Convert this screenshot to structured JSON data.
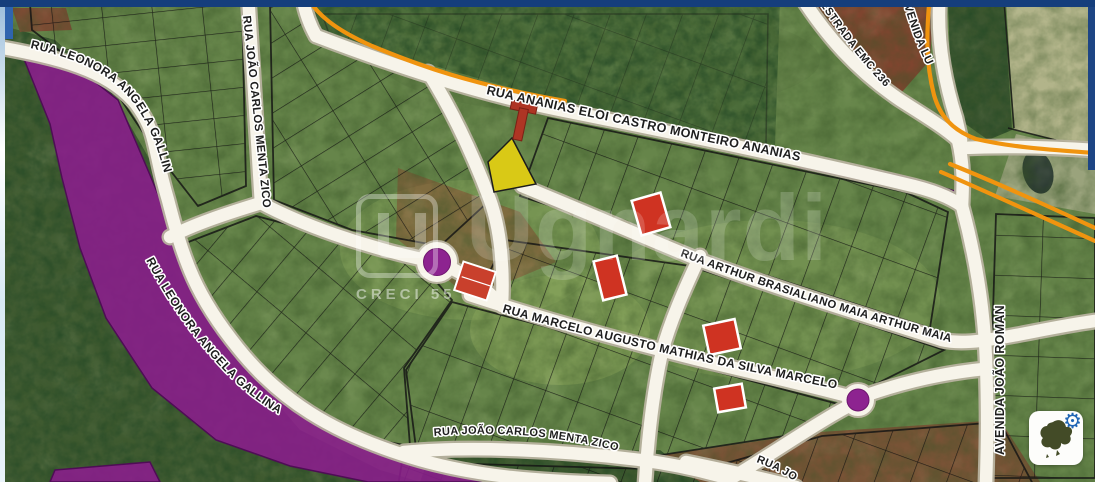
{
  "window": {
    "top_bar_color": "#153e7c",
    "right_edge_color": "#1d4584"
  },
  "map": {
    "type": "cadastral-aerial-viewer",
    "streets": [
      {
        "id": "leonora-gallina-1",
        "label": "RUA LEONORA ANGELA GALLINA"
      },
      {
        "id": "leonora-gallina-2",
        "label": "RUA LEONORA ANGELA GALLINA"
      },
      {
        "id": "zico-north",
        "label": "RUA JOÃO CARLOS MENTA ZICO"
      },
      {
        "id": "zico-south",
        "label": "RUA JOÃO CARLOS MENTA ZICO"
      },
      {
        "id": "ananias",
        "label": "RUA ANANIAS ELOI CASTRO MONTEIRO ANANIAS"
      },
      {
        "id": "arthur-maia",
        "label": "RUA ARTHUR BRASIALIANO MAIA ARTHUR MAIA"
      },
      {
        "id": "marcelo",
        "label": "RUA MARCELO AUGUSTO MATHIAS DA SILVA MARCELO"
      },
      {
        "id": "estrada-emc",
        "label": "ESTRADA EMC 236"
      },
      {
        "id": "avenida-lu",
        "label": "AVENIDA LU"
      },
      {
        "id": "avenida-joao-roman",
        "label": "AVENIDA JOÃO ROMAN"
      },
      {
        "id": "rua-jo-partial",
        "label": "RUA JO"
      }
    ],
    "zones": [
      {
        "name": "restricted-area-west",
        "color": "#8b1d8d"
      },
      {
        "name": "restricted-area-northeast",
        "color": "#8b1d8d"
      },
      {
        "name": "restricted-area-south",
        "color": "#8b1d8d"
      }
    ],
    "highlight_roads": {
      "color": "#f0940f"
    },
    "markers": [
      {
        "shape": "circle",
        "fill": "#8d2390",
        "ring": "#ffffff",
        "x": 437,
        "y": 262
      },
      {
        "shape": "circle",
        "fill": "#8d2390",
        "ring": "#ffffff",
        "x": 858,
        "y": 400
      }
    ],
    "lots": [
      {
        "status_color": "#cf3322",
        "x": 651,
        "y": 214
      },
      {
        "status_color": "#cf3322",
        "x": 610,
        "y": 278
      },
      {
        "status_color": "#cf3322",
        "x": 722,
        "y": 337
      },
      {
        "status_color": "#cf3322",
        "x": 730,
        "y": 398
      },
      {
        "status_color": "#d9c916",
        "x": 512,
        "y": 168
      }
    ]
  },
  "watermark": {
    "brand": "Ugnardi",
    "creci": "CRECI 55"
  },
  "controls": {
    "minimap_widget": {
      "gear_glyph": "⚙"
    }
  }
}
